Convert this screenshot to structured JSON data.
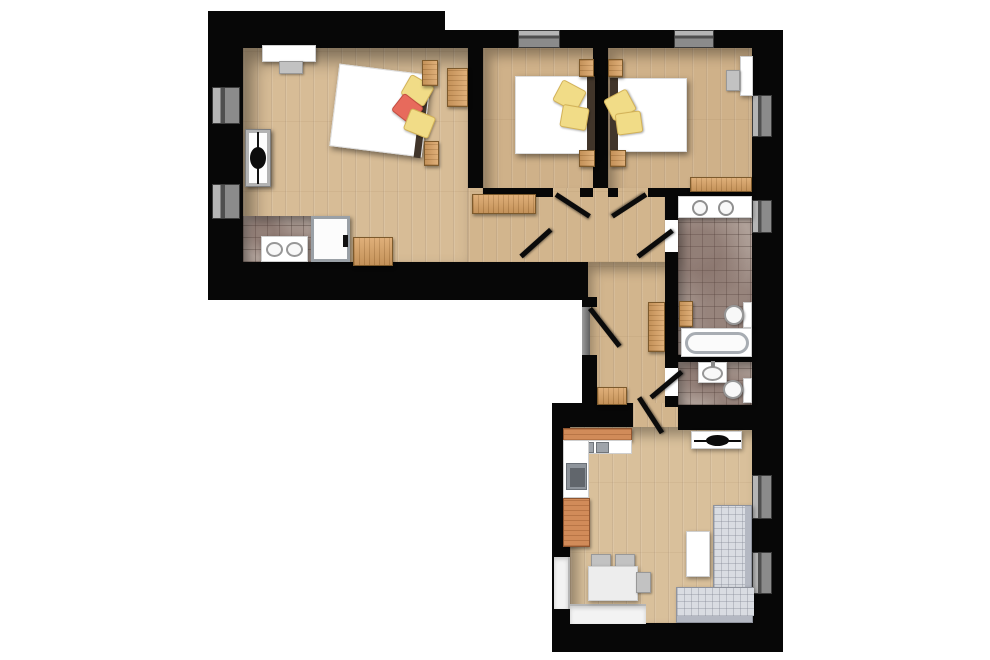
{
  "meta": {
    "type": "architectural-floor-plan",
    "view": "top-down-3d-render",
    "visible_text": [],
    "wings": "L-shaped apartment: upper wing with three bedrooms and hallway, lower wing with living-kitchen, connected by corridor with bathrooms"
  },
  "palette": {
    "background": "#ffffff",
    "wall": "#070707",
    "wood_base": "#d7bc96",
    "wood_mid": "#cfb189",
    "wood_hall": "#d2b58d",
    "wood_living": "#d9c09b",
    "tile_base": "#b0a199",
    "furniture_wood": "#daa263",
    "kitchen_counter": "#d18b59",
    "fixture_white": "#ffffff",
    "pillow_yellow": "#f1dc87",
    "pillow_red": "#e76a5c",
    "sofa_body": "#b4b8c2",
    "sofa_seat": "#d9dce2"
  },
  "rooms": [
    {
      "id": "bedroom-left",
      "label": "left bedroom with en-suite corner",
      "furniture": [
        "desk",
        "desk chair",
        "double bed",
        "yellow pillow",
        "red pillow",
        "yellow pillow",
        "wood stove",
        "wardrobe",
        "nightstand",
        "nightstand",
        "double-sink vanity",
        "shower cabin",
        "cabinet",
        "tiled floor corner"
      ]
    },
    {
      "id": "bedroom-middle",
      "label": "middle bedroom",
      "furniture": [
        "bed",
        "yellow pillow",
        "yellow pillow",
        "nightstand",
        "nightstand",
        "hall bench"
      ]
    },
    {
      "id": "bedroom-right",
      "label": "right bedroom",
      "furniture": [
        "bed",
        "yellow pillow",
        "yellow pillow",
        "nightstand",
        "nightstand",
        "desk",
        "desk chair",
        "bench"
      ]
    },
    {
      "id": "bathroom-main",
      "label": "main bathroom",
      "furniture": [
        "double-sink vanity",
        "toilet",
        "bathtub",
        "wood shelf"
      ]
    },
    {
      "id": "wc",
      "label": "guest WC",
      "furniture": [
        "washbasin",
        "toilet"
      ]
    },
    {
      "id": "hall-corridor",
      "label": "hallway and corridor",
      "furniture": [
        "bench",
        "cabinet",
        "tall cabinet",
        "low cabinet",
        "entrance door"
      ]
    },
    {
      "id": "living-kitchen",
      "label": "living room with open kitchen",
      "furniture": [
        "L-shaped kitchen counter",
        "cooktop",
        "kitchen sink",
        "fireplace stove",
        "dining table",
        "chair",
        "chair",
        "chair",
        "corner sofa",
        "coffee table"
      ]
    }
  ],
  "counts": {
    "windows": 10,
    "door_leaves": 7,
    "beds": 3,
    "toilets": 2,
    "sinks": 7
  }
}
